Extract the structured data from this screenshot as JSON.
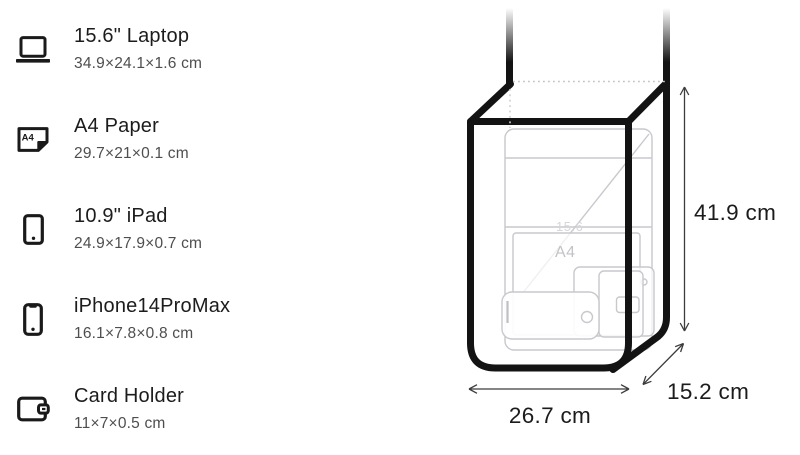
{
  "page": {
    "background": "#ffffff"
  },
  "items": [
    {
      "title": "15.6\" Laptop",
      "dims": "34.9×24.1×1.6 cm"
    },
    {
      "title": "A4 Paper",
      "dims": "29.7×21×0.1 cm",
      "icon_text": "A4"
    },
    {
      "title": "10.9\" iPad",
      "dims": "24.9×17.9×0.7 cm"
    },
    {
      "title": "iPhone14ProMax",
      "dims": "16.1×7.8×0.8 cm"
    },
    {
      "title": "Card Holder",
      "dims": "11×7×0.5 cm"
    }
  ],
  "diagram": {
    "height_label": "41.9 cm",
    "width_label": "26.7 cm",
    "depth_label": "15.2 cm",
    "ghost_laptop_label": "15.6",
    "ghost_a4_label": "A4",
    "colors": {
      "bag_outline": "#131313",
      "ghost_line": "#c8c8ce",
      "dotted_line": "#c4c4c4",
      "arrow": "#3c3c3c",
      "title_text": "#1c1c1c",
      "secondary_text": "#4e4e4e",
      "dimension_text": "#1b1b1b"
    }
  }
}
